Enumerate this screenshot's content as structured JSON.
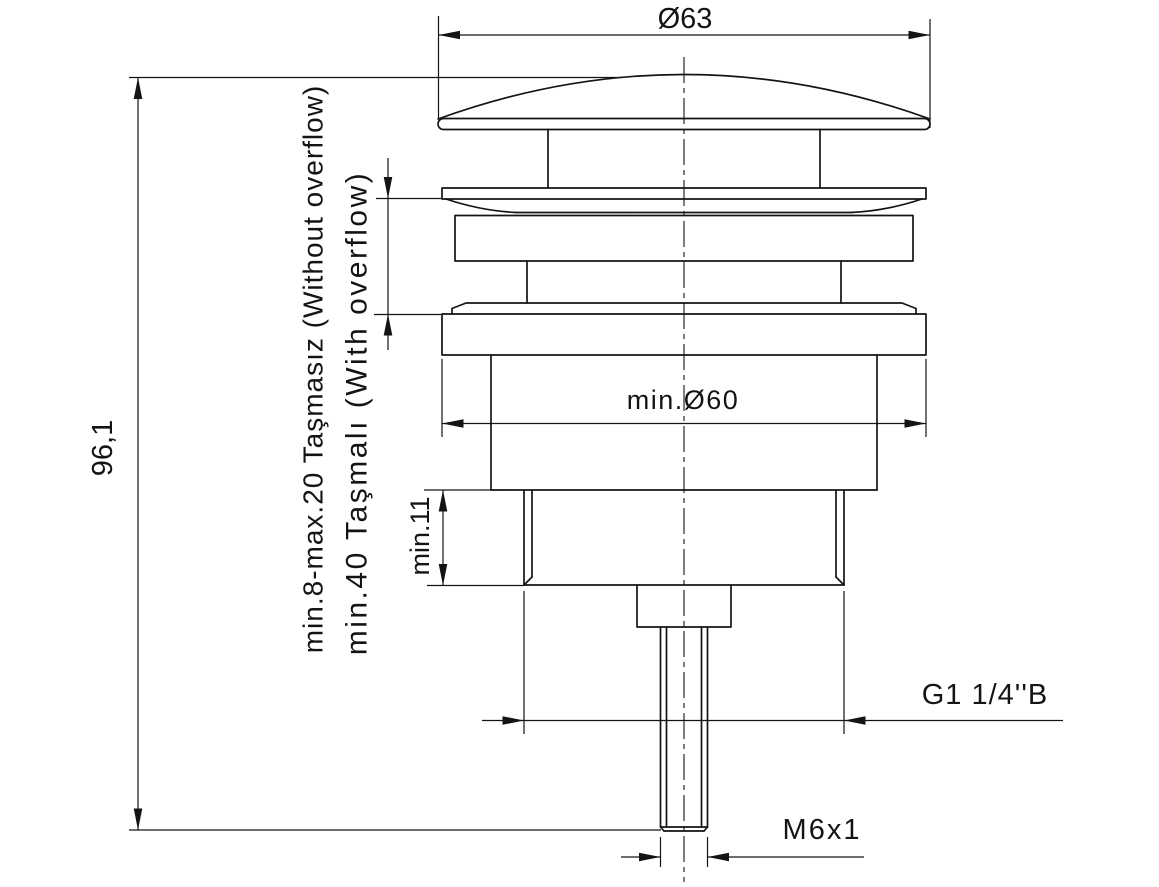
{
  "drawing": {
    "type": "technical-drawing",
    "subject": "clic-clac basin waste valve section",
    "colors": {
      "line": "#141414",
      "background": "#ffffff"
    },
    "labels": {
      "diameter_top": "Ø63",
      "overall_height": "96,1",
      "mount_without_overflow": "min.8-max.20 Taşmasız (Without overflow)",
      "mount_with_overflow": "min.40 Taşmalı (With overflow)",
      "min_installation_diameter": "min.Ø60",
      "min_thread_length": "min.11",
      "outlet_thread": "G1 1/4''B",
      "rod_thread": "M6x1"
    }
  }
}
